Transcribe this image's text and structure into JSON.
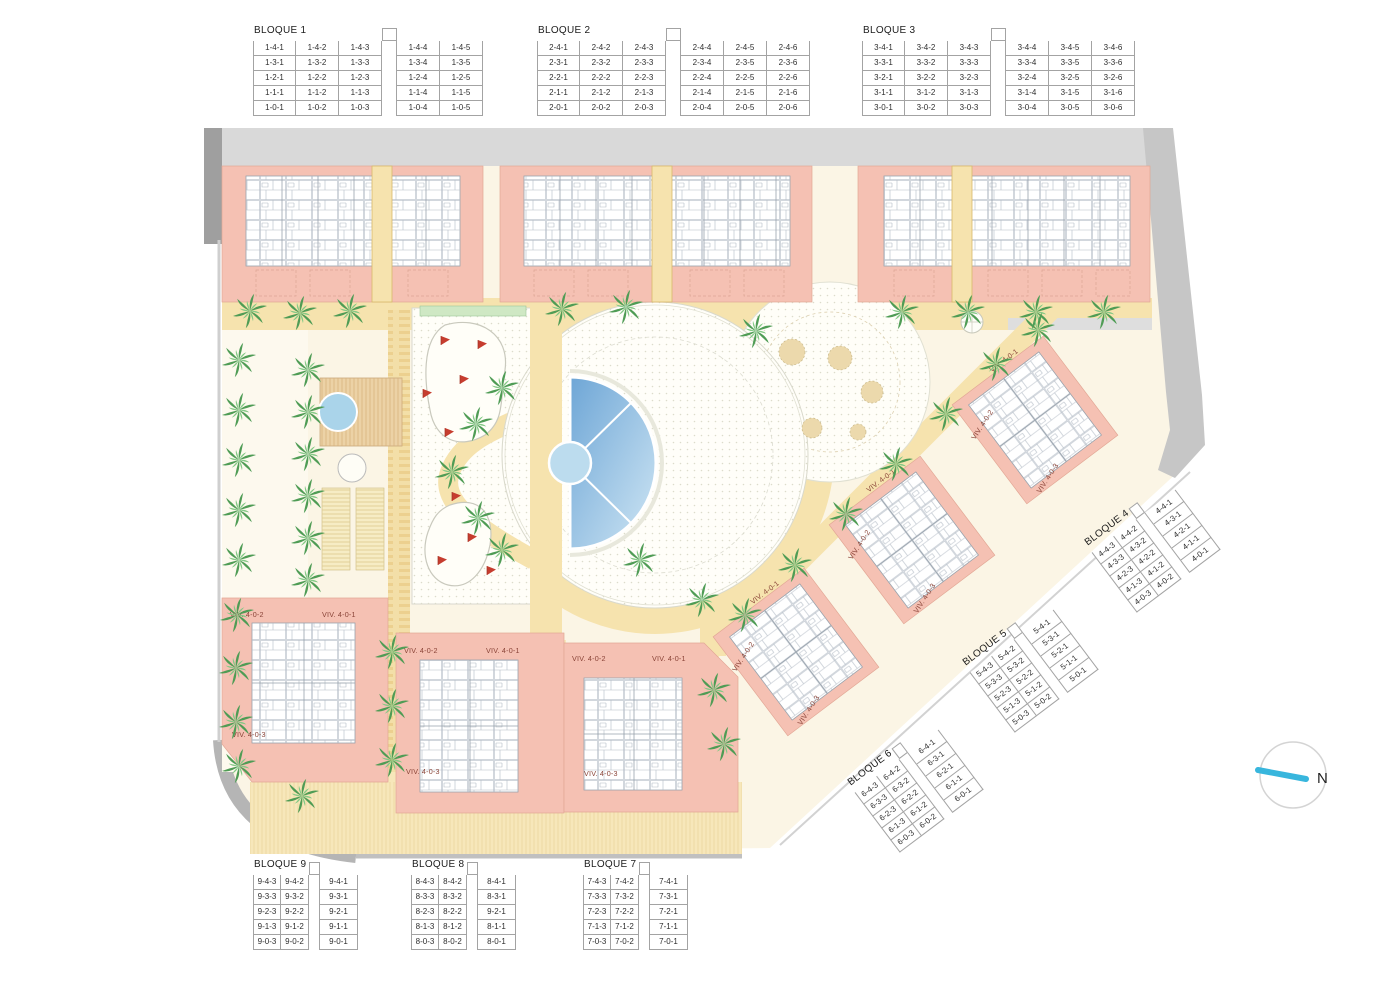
{
  "plan": {
    "north_label": "N",
    "viv": {
      "v1": "VIV. 4-0-1",
      "v2": "VIV. 4-0-2",
      "v3": "VIV. 4-0-3"
    },
    "colors": {
      "building_pink": "#f5c1b3",
      "path_yellow": "#f6e3ae",
      "pool_blue": "#6ea6d6",
      "road_gray": "#d9d9d9",
      "flag_red": "#c63d2f",
      "north_cyan": "#38b6dd"
    }
  },
  "tables": {
    "b1": {
      "title": "BLOQUE 1",
      "rows": [
        [
          "1-4-1",
          "1-4-2",
          "1-4-3",
          "",
          "1-4-4",
          "1-4-5"
        ],
        [
          "1-3-1",
          "1-3-2",
          "1-3-3",
          "",
          "1-3-4",
          "1-3-5"
        ],
        [
          "1-2-1",
          "1-2-2",
          "1-2-3",
          "",
          "1-2-4",
          "1-2-5"
        ],
        [
          "1-1-1",
          "1-1-2",
          "1-1-3",
          "",
          "1-1-4",
          "1-1-5"
        ],
        [
          "1-0-1",
          "1-0-2",
          "1-0-3",
          "",
          "1-0-4",
          "1-0-5"
        ]
      ]
    },
    "b2": {
      "title": "BLOQUE 2",
      "rows": [
        [
          "2-4-1",
          "2-4-2",
          "2-4-3",
          "",
          "2-4-4",
          "2-4-5",
          "2-4-6"
        ],
        [
          "2-3-1",
          "2-3-2",
          "2-3-3",
          "",
          "2-3-4",
          "2-3-5",
          "2-3-6"
        ],
        [
          "2-2-1",
          "2-2-2",
          "2-2-3",
          "",
          "2-2-4",
          "2-2-5",
          "2-2-6"
        ],
        [
          "2-1-1",
          "2-1-2",
          "2-1-3",
          "",
          "2-1-4",
          "2-1-5",
          "2-1-6"
        ],
        [
          "2-0-1",
          "2-0-2",
          "2-0-3",
          "",
          "2-0-4",
          "2-0-5",
          "2-0-6"
        ]
      ]
    },
    "b3": {
      "title": "BLOQUE 3",
      "rows": [
        [
          "3-4-1",
          "3-4-2",
          "3-4-3",
          "",
          "3-4-4",
          "3-4-5",
          "3-4-6"
        ],
        [
          "3-3-1",
          "3-3-2",
          "3-3-3",
          "",
          "3-3-4",
          "3-3-5",
          "3-3-6"
        ],
        [
          "3-2-1",
          "3-2-2",
          "3-2-3",
          "",
          "3-2-4",
          "3-2-5",
          "3-2-6"
        ],
        [
          "3-1-1",
          "3-1-2",
          "3-1-3",
          "",
          "3-1-4",
          "3-1-5",
          "3-1-6"
        ],
        [
          "3-0-1",
          "3-0-2",
          "3-0-3",
          "",
          "3-0-4",
          "3-0-5",
          "3-0-6"
        ]
      ]
    },
    "b4": {
      "title": "BLOQUE 4",
      "rows": [
        [
          "4-4-3",
          "4-4-2",
          "",
          "4-4-1"
        ],
        [
          "4-3-3",
          "4-3-2",
          "",
          "4-3-1"
        ],
        [
          "4-2-3",
          "4-2-2",
          "",
          "4-2-1"
        ],
        [
          "4-1-3",
          "4-1-2",
          "",
          "4-1-1"
        ],
        [
          "4-0-3",
          "4-0-2",
          "",
          "4-0-1"
        ]
      ]
    },
    "b5": {
      "title": "BLOQUE 5",
      "rows": [
        [
          "5-4-3",
          "5-4-2",
          "",
          "5-4-1"
        ],
        [
          "5-3-3",
          "5-3-2",
          "",
          "5-3-1"
        ],
        [
          "5-2-3",
          "5-2-2",
          "",
          "5-2-1"
        ],
        [
          "5-1-3",
          "5-1-2",
          "",
          "5-1-1"
        ],
        [
          "5-0-3",
          "5-0-2",
          "",
          "5-0-1"
        ]
      ]
    },
    "b6": {
      "title": "BLOQUE 6",
      "rows": [
        [
          "6-4-3",
          "6-4-2",
          "",
          "6-4-1"
        ],
        [
          "6-3-3",
          "6-3-2",
          "",
          "6-3-1"
        ],
        [
          "6-2-3",
          "6-2-2",
          "",
          "6-2-1"
        ],
        [
          "6-1-3",
          "6-1-2",
          "",
          "6-1-1"
        ],
        [
          "6-0-3",
          "6-0-2",
          "",
          "6-0-1"
        ]
      ]
    },
    "b7": {
      "title": "BLOQUE 7",
      "rows": [
        [
          "7-4-3",
          "7-4-2",
          "",
          "7-4-1"
        ],
        [
          "7-3-3",
          "7-3-2",
          "",
          "7-3-1"
        ],
        [
          "7-2-3",
          "7-2-2",
          "",
          "7-2-1"
        ],
        [
          "7-1-3",
          "7-1-2",
          "",
          "7-1-1"
        ],
        [
          "7-0-3",
          "7-0-2",
          "",
          "7-0-1"
        ]
      ]
    },
    "b8": {
      "title": "BLOQUE 8",
      "rows": [
        [
          "8-4-3",
          "8-4-2",
          "",
          "8-4-1"
        ],
        [
          "8-3-3",
          "8-3-2",
          "",
          "8-3-1"
        ],
        [
          "8-2-3",
          "8-2-2",
          "",
          "9-2-1"
        ],
        [
          "8-1-3",
          "8-1-2",
          "",
          "8-1-1"
        ],
        [
          "8-0-3",
          "8-0-2",
          "",
          "8-0-1"
        ]
      ]
    },
    "b9": {
      "title": "BLOQUE 9",
      "rows": [
        [
          "9-4-3",
          "9-4-2",
          "",
          "9-4-1"
        ],
        [
          "9-3-3",
          "9-3-2",
          "",
          "9-3-1"
        ],
        [
          "9-2-3",
          "9-2-2",
          "",
          "9-2-1"
        ],
        [
          "9-1-3",
          "9-1-2",
          "",
          "9-1-1"
        ],
        [
          "9-0-3",
          "9-0-2",
          "",
          "9-0-1"
        ]
      ]
    }
  }
}
